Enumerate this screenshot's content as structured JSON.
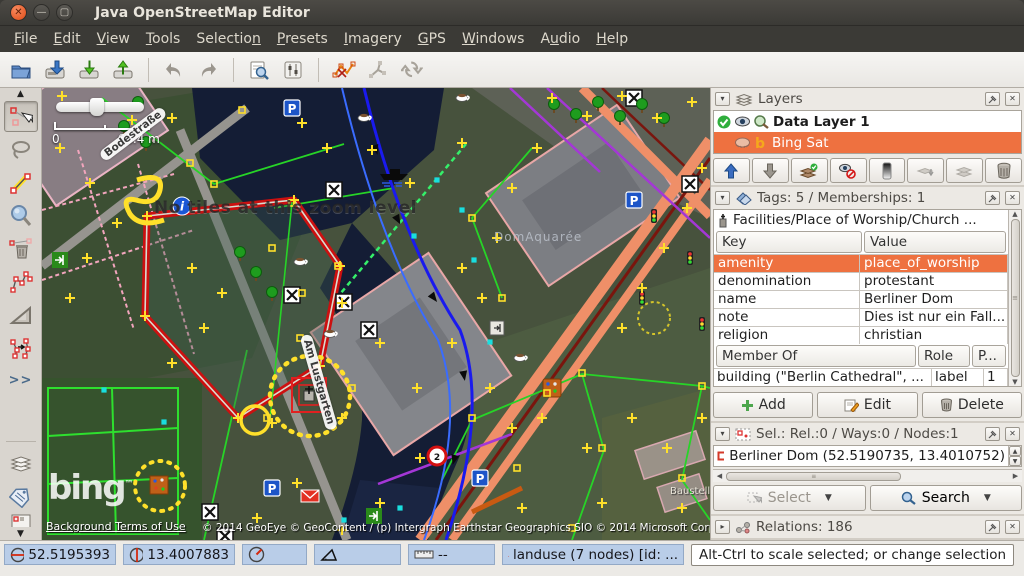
{
  "colors": {
    "accent_orange": "#ee7140",
    "status_blue": "#b9cde8",
    "selection_red": "#cc1010",
    "node_yellow": "#ffe02a",
    "titlebar_bg": "#3b3a36"
  },
  "window": {
    "title": "Java OpenStreetMap Editor"
  },
  "menu": {
    "items": [
      {
        "pre": "",
        "mn": "F",
        "post": "ile"
      },
      {
        "pre": "",
        "mn": "E",
        "post": "dit"
      },
      {
        "pre": "",
        "mn": "V",
        "post": "iew"
      },
      {
        "pre": "",
        "mn": "T",
        "post": "ools"
      },
      {
        "pre": "Selectio",
        "mn": "n",
        "post": ""
      },
      {
        "pre": "",
        "mn": "P",
        "post": "resets"
      },
      {
        "pre": "",
        "mn": "I",
        "post": "magery"
      },
      {
        "pre": "",
        "mn": "G",
        "post": "PS"
      },
      {
        "pre": "",
        "mn": "W",
        "post": "indows"
      },
      {
        "pre": "A",
        "mn": "u",
        "post": "dio"
      },
      {
        "pre": "",
        "mn": "H",
        "post": "elp"
      }
    ]
  },
  "toolbar": {
    "icons": [
      "open-icon",
      "save-icon",
      "download-icon",
      "upload-icon",
      "undo-icon",
      "redo-icon",
      "search-preset-icon",
      "preferences-icon",
      "merge-ways-icon",
      "split-way-icon",
      "refresh-icon"
    ]
  },
  "left_toolbar": {
    "tools": [
      "select",
      "lasso",
      "draw-node",
      "zoom",
      "delete",
      "parallel-way",
      "extrude",
      "improve-accuracy"
    ],
    "more_label": ">>"
  },
  "map_overlay": {
    "scale_zero": "0",
    "scale_label": "68.4 m",
    "no_tiles_message": "No tiles at this zoom level",
    "bing_logo": "bing",
    "bing_tm": "™",
    "terms_link": "Background Terms of Use",
    "copyright": "© 2014 GeoEye © GeoContent / (p) Intergraph Earthstar Geographics SIO © 2014 Microsoft Corporation",
    "area_label": "DomAquarée",
    "street_label_1": "Bodestraße",
    "street_label_2": "Am Lustgarten",
    "construction_label": "Baustelle"
  },
  "layers_panel": {
    "title": "Layers",
    "layers": [
      {
        "name": "Data Layer 1"
      },
      {
        "name": "Bing Sat"
      }
    ],
    "button_icons": [
      "layer-up-icon",
      "layer-down-icon",
      "activate-layer-icon",
      "show-hide-icon",
      "opacity-icon",
      "merge-layer-icon",
      "duplicate-layer-icon",
      "delete-layer-icon"
    ]
  },
  "tags_panel": {
    "title": "Tags: 5 / Memberships: 1",
    "preset_label": "Facilities/Place of Worship/Church ...",
    "key_header": "Key",
    "value_header": "Value",
    "rows": [
      {
        "key": "amenity",
        "value": "place_of_worship"
      },
      {
        "key": "denomination",
        "value": "protestant"
      },
      {
        "key": "name",
        "value": "Berliner Dom"
      },
      {
        "key": "note",
        "value": "Dies ist nur ein Fall..."
      },
      {
        "key": "religion",
        "value": "christian"
      }
    ],
    "member_header": "Member Of",
    "role_header": "Role",
    "position_header": "P...",
    "membership": {
      "member": "building (\"Berlin Cathedral\", ...",
      "role": "label",
      "position": "1"
    },
    "add_label": "Add",
    "edit_label": "Edit",
    "delete_label": "Delete"
  },
  "selection_panel": {
    "title": "Sel.: Rel.:0 / Ways:0 / Nodes:1",
    "items": [
      {
        "label": "Berliner Dom (52.5190735, 13.4010752)"
      }
    ],
    "select_label": "Select",
    "search_label": "Search"
  },
  "relations_panel": {
    "title": "Relations: 186"
  },
  "statusbar": {
    "lat": "52.5195393",
    "lon": "13.4007883",
    "distance": "--",
    "object_info": "landuse (7 nodes) [id: ...",
    "help": "Alt-Ctrl to scale selected; or change selection"
  }
}
